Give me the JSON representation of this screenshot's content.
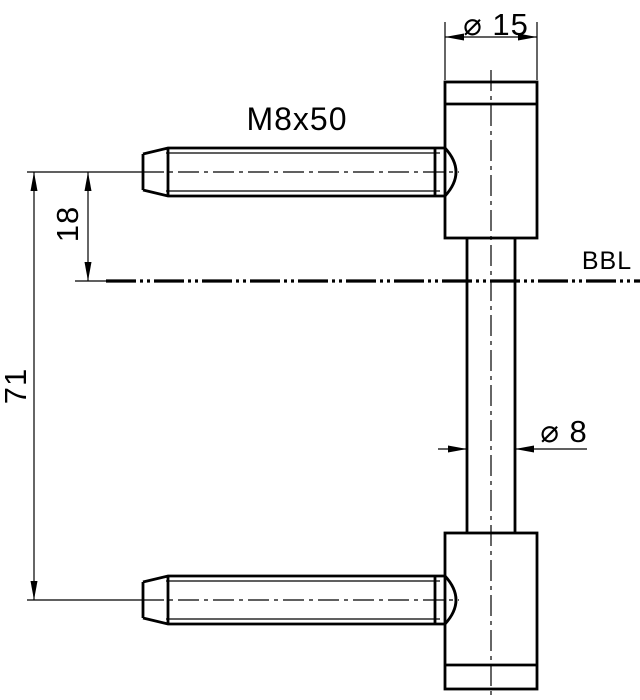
{
  "drawing": {
    "labels": {
      "top_diameter": "⌀ 15",
      "thread_spec": "M8x50",
      "bbl_offset": "18",
      "pin_spacing": "71",
      "reference": "BBL",
      "rod_diameter": "⌀ 8"
    },
    "colors": {
      "line": "#000000",
      "background": "#ffffff"
    }
  }
}
